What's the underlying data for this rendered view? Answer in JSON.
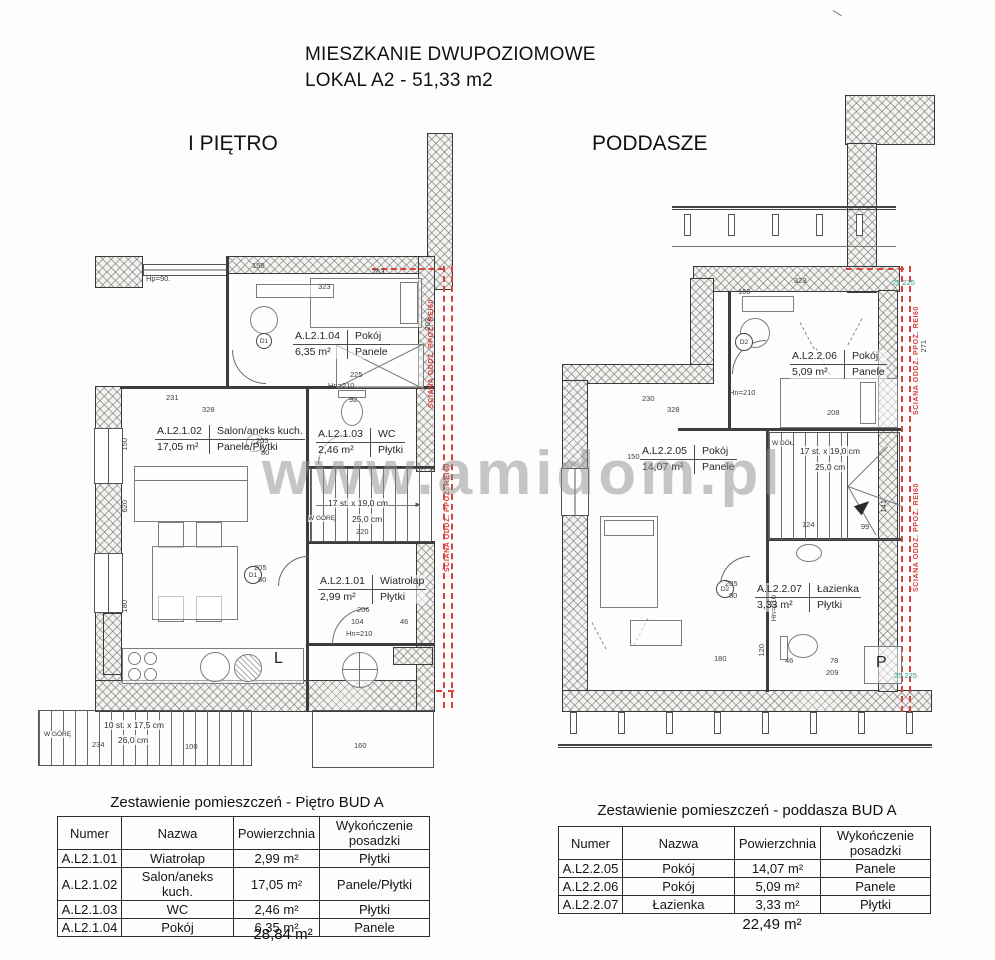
{
  "page": {
    "title_line1": "MIESZKANIE DWUPOZIOMOWE",
    "title_line2": "LOKAL A2 - 51,33 m2",
    "watermark": "www.amidom.pl"
  },
  "colors": {
    "fire_red": "#d9413d",
    "teal": "#2f9e8f",
    "watermark_gray": "#8f8f8f"
  },
  "plans": [
    {
      "label": "I PIĘTRO",
      "fire_text": "ŚCIANA ODDZ. PPOŻ. REI60",
      "door_label": "D1",
      "kitchen_letter": "L",
      "rooms": [
        {
          "num": "A.L2.1.04",
          "name": "Pokój",
          "area": "6,35 m²",
          "floor": "Panele"
        },
        {
          "num": "A.L2.1.02",
          "name": "Salon/aneks kuch.",
          "area": "17,05 m²",
          "floor": "Panele/Płytki"
        },
        {
          "num": "A.L2.1.03",
          "name": "WC",
          "area": "2,46 m²",
          "floor": "Płytki"
        },
        {
          "num": "A.L2.1.01",
          "name": "Wiatrołap",
          "area": "2,99 m²",
          "floor": "Płytki"
        }
      ],
      "stairs": {
        "steps": "17 st. x 19,0 cm",
        "depth": "25,0 cm",
        "dir": "W GÓRĘ",
        "width_label": "220"
      },
      "ext_stairs": {
        "steps": "10 st. x 17,5 cm",
        "depth": "26,0 cm",
        "dir": "W GÓRĘ"
      },
      "dims": [
        "150",
        "163",
        "323",
        "Hp=90.",
        "231",
        "328",
        "Hn=210",
        "92",
        "205",
        "80",
        "220",
        "206",
        "104",
        "46",
        "Hn=210",
        "620",
        "150",
        "180",
        "203",
        "225",
        "234",
        "100",
        "160",
        "205",
        "80"
      ]
    },
    {
      "label": "PODDASZE",
      "fire_text": "ŚCIANA ODDZ. PPOŻ. REI60",
      "door_label": "D2",
      "washer_letter": "P",
      "rooms": [
        {
          "num": "A.L2.2.06",
          "name": "Pokój",
          "area": "5,09 m²",
          "floor": "Panele"
        },
        {
          "num": "A.L2.2.05",
          "name": "Pokój",
          "area": "14,07 m²",
          "floor": "Panele"
        },
        {
          "num": "A.L2.2.07",
          "name": "Łazienka",
          "area": "3,33 m²",
          "floor": "Płytki"
        }
      ],
      "stairs": {
        "steps": "17 st. x 19,0 cm",
        "depth": "25,0 cm",
        "dir": "W DÓŁ"
      },
      "dims": [
        "323",
        "160",
        "230",
        "328",
        "208",
        "271",
        "Hn=210",
        "150",
        "124",
        "99",
        "141",
        "180",
        "46",
        "78",
        "209",
        "120",
        "205",
        "80",
        "25 225",
        "25 225",
        "Hn=210"
      ]
    }
  ],
  "tables": [
    {
      "title": "Zestawienie pomieszczeń - Piętro BUD A",
      "headers": [
        "Numer",
        "Nazwa",
        "Powierzchnia",
        "Wykończenie posadzki"
      ],
      "rows": [
        [
          "A.L2.1.01",
          "Wiatrołap",
          "2,99 m²",
          "Płytki"
        ],
        [
          "A.L2.1.02",
          "Salon/aneks kuch.",
          "17,05 m²",
          "Panele/Płytki"
        ],
        [
          "A.L2.1.03",
          "WC",
          "2,46 m²",
          "Płytki"
        ],
        [
          "A.L2.1.04",
          "Pokój",
          "6,35 m²",
          "Panele"
        ]
      ],
      "total": "28,84 m²"
    },
    {
      "title": "Zestawienie pomieszczeń - poddasza BUD A",
      "headers": [
        "Numer",
        "Nazwa",
        "Powierzchnia",
        "Wykończenie posadzki"
      ],
      "rows": [
        [
          "A.L2.2.05",
          "Pokój",
          "14,07 m²",
          "Panele"
        ],
        [
          "A.L2.2.06",
          "Pokój",
          "5,09 m²",
          "Panele"
        ],
        [
          "A.L2.2.07",
          "Łazienka",
          "3,33 m²",
          "Płytki"
        ]
      ],
      "total": "22,49 m²"
    }
  ]
}
